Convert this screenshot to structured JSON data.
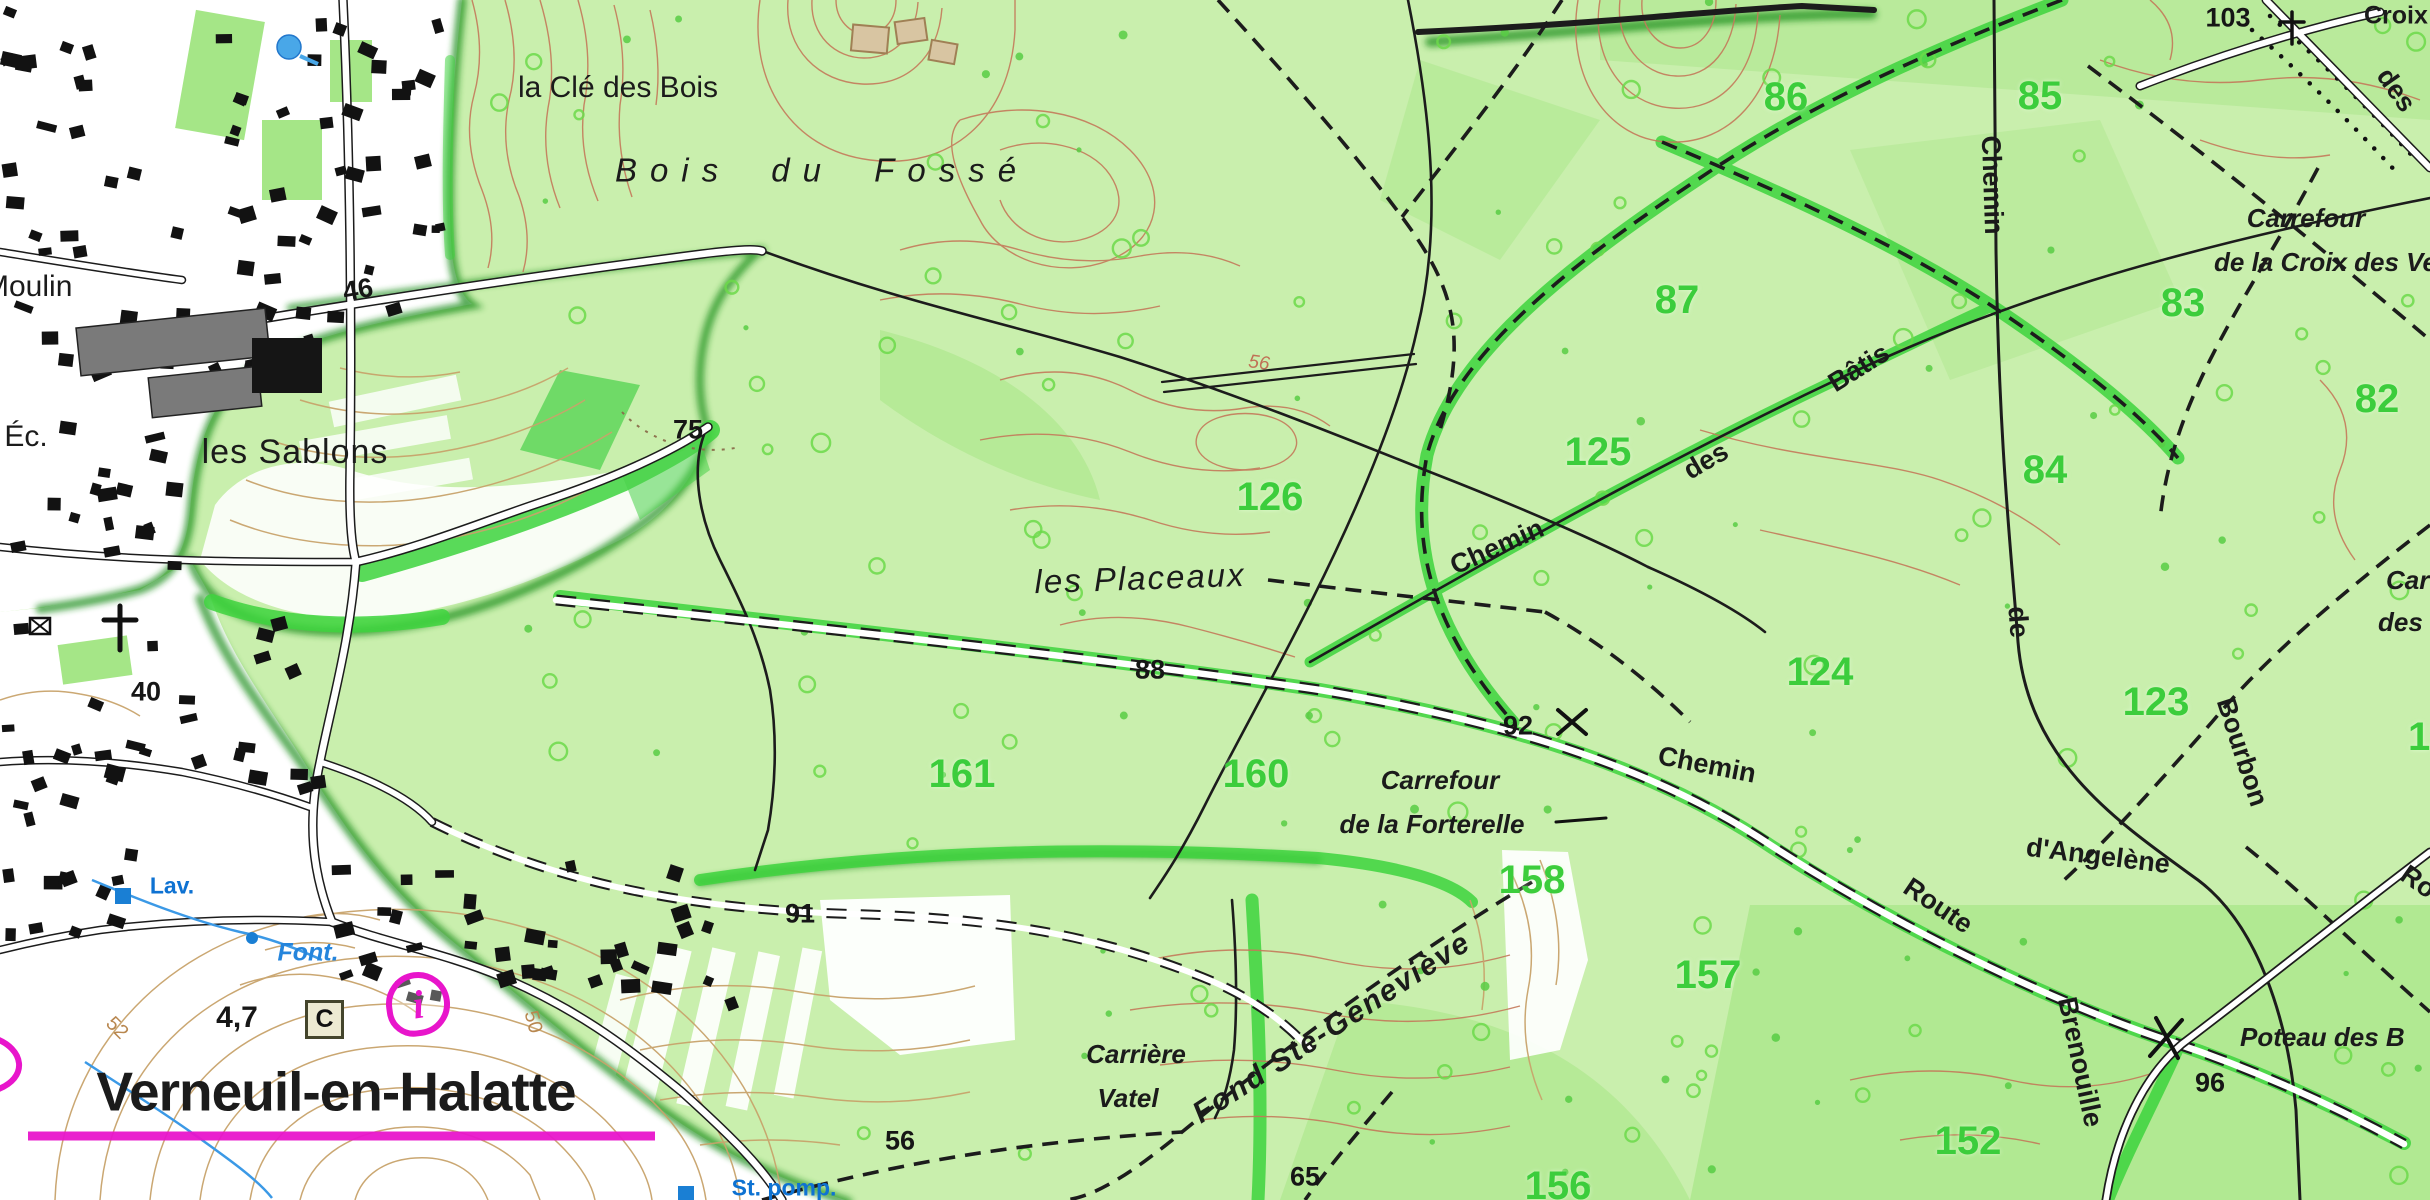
{
  "map_title": "Verneuil-en-Halatte forest topographic map extract",
  "colors": {
    "forest_base": "#c9efad",
    "forest_medium": "#8fe06a",
    "path_highlight": "#3ed43e",
    "forest_edge_dark": "#1f8f1f",
    "contour_open": "#c8a36b",
    "contour_forest": "#c4795a",
    "parcel_number_green": "#3ccd3c",
    "hydro_blue": "#1a7fd4",
    "tourism_magenta": "#e815cb",
    "road_black": "#1c1c1c",
    "urban_white": "#ffffff"
  },
  "symbols": {
    "info": "i",
    "cadastre_box": "C",
    "cross_103": "calvary-cross",
    "cross_verneuil": "calvary-cross",
    "crossing_92": "x-mark",
    "crossing_96": "x-mark"
  },
  "labels": [
    {
      "name": "place-la-cle-des-bois",
      "text": "la Clé des Bois",
      "x": 618,
      "y": 88,
      "rot": 0,
      "cls": "place"
    },
    {
      "name": "place-bois-du-fosse",
      "text": "Bois du Fossé",
      "x": 822,
      "y": 170,
      "rot": 0,
      "cls": "wood"
    },
    {
      "name": "place-les-sablons",
      "text": "les Sablons",
      "x": 295,
      "y": 452,
      "rot": 0,
      "cls": "place-lg"
    },
    {
      "name": "place-les-placeaux",
      "text": "les Placeaux",
      "x": 1140,
      "y": 578,
      "rot": -2,
      "cls": "lieu"
    },
    {
      "name": "place-moulin",
      "text": "Moulin",
      "x": -16,
      "y": 287,
      "rot": 0,
      "cls": "place anchor-l"
    },
    {
      "name": "place-ec",
      "text": "Éc.",
      "x": 26,
      "y": 437,
      "rot": 0,
      "cls": "place"
    },
    {
      "name": "town-verneuil-en-halatte",
      "text": "Verneuil-en-Halatte",
      "x": 336,
      "y": 1092,
      "rot": 0,
      "cls": "town"
    },
    {
      "name": "place-carriere",
      "text": "Carrière",
      "x": 1136,
      "y": 1054,
      "rot": 0,
      "cls": "carrefour"
    },
    {
      "name": "place-vatel",
      "text": "Vatel",
      "x": 1128,
      "y": 1098,
      "rot": 0,
      "cls": "carrefour"
    },
    {
      "name": "place-fond-ste-genevieve",
      "text": "Fond Ste-Geneviève",
      "x": 1332,
      "y": 1028,
      "rot": -33,
      "cls": "carrefour-lg"
    },
    {
      "name": "carrefour-forterelle-line1",
      "text": "Carrefour",
      "x": 1440,
      "y": 780,
      "rot": 0,
      "cls": "carrefour"
    },
    {
      "name": "carrefour-forterelle-line2",
      "text": "de la Forterelle",
      "x": 1432,
      "y": 824,
      "rot": 0,
      "cls": "carrefour"
    },
    {
      "name": "carrefour-croix-veneurs-line1",
      "text": "Carrefour",
      "x": 2306,
      "y": 218,
      "rot": 0,
      "cls": "carrefour"
    },
    {
      "name": "carrefour-croix-veneurs-line2",
      "text": "de la Croix des Veneu",
      "x": 2214,
      "y": 262,
      "rot": 0,
      "cls": "carrefour anchor-l"
    },
    {
      "name": "place-poteau-des-b",
      "text": "Poteau des B",
      "x": 2240,
      "y": 1037,
      "rot": 0,
      "cls": "carrefour anchor-l"
    },
    {
      "name": "place-car-cut",
      "text": "Car",
      "x": 2386,
      "y": 580,
      "rot": 0,
      "cls": "carrefour anchor-l"
    },
    {
      "name": "place-des-v-cut",
      "text": "des V",
      "x": 2378,
      "y": 622,
      "rot": 0,
      "cls": "carrefour anchor-l"
    },
    {
      "name": "place-croix",
      "text": "Croix",
      "x": 2364,
      "y": 16,
      "rot": 0,
      "cls": "croix anchor-l"
    },
    {
      "name": "parcel-86",
      "text": "86",
      "x": 1786,
      "y": 97,
      "rot": 0,
      "cls": "parcel"
    },
    {
      "name": "parcel-85",
      "text": "85",
      "x": 2040,
      "y": 96,
      "rot": 0,
      "cls": "parcel"
    },
    {
      "name": "parcel-87",
      "text": "87",
      "x": 1677,
      "y": 300,
      "rot": 0,
      "cls": "parcel"
    },
    {
      "name": "parcel-83",
      "text": "83",
      "x": 2183,
      "y": 303,
      "rot": 0,
      "cls": "parcel"
    },
    {
      "name": "parcel-82",
      "text": "82",
      "x": 2377,
      "y": 399,
      "rot": 0,
      "cls": "parcel"
    },
    {
      "name": "parcel-84",
      "text": "84",
      "x": 2045,
      "y": 470,
      "rot": 0,
      "cls": "parcel"
    },
    {
      "name": "parcel-125",
      "text": "125",
      "x": 1598,
      "y": 452,
      "rot": 0,
      "cls": "parcel"
    },
    {
      "name": "parcel-126",
      "text": "126",
      "x": 1270,
      "y": 497,
      "rot": 0,
      "cls": "parcel"
    },
    {
      "name": "parcel-124",
      "text": "124",
      "x": 1820,
      "y": 672,
      "rot": 0,
      "cls": "parcel"
    },
    {
      "name": "parcel-123",
      "text": "123",
      "x": 2156,
      "y": 702,
      "rot": 0,
      "cls": "parcel"
    },
    {
      "name": "parcel-12-cut",
      "text": "12",
      "x": 2408,
      "y": 737,
      "rot": 0,
      "cls": "parcel anchor-l"
    },
    {
      "name": "parcel-161",
      "text": "161",
      "x": 962,
      "y": 774,
      "rot": 0,
      "cls": "parcel"
    },
    {
      "name": "parcel-160",
      "text": "160",
      "x": 1256,
      "y": 774,
      "rot": 0,
      "cls": "parcel"
    },
    {
      "name": "parcel-158",
      "text": "158",
      "x": 1532,
      "y": 880,
      "rot": 0,
      "cls": "parcel"
    },
    {
      "name": "parcel-157",
      "text": "157",
      "x": 1708,
      "y": 975,
      "rot": 0,
      "cls": "parcel"
    },
    {
      "name": "parcel-156",
      "text": "156",
      "x": 1558,
      "y": 1186,
      "rot": 0,
      "cls": "parcel"
    },
    {
      "name": "parcel-152",
      "text": "152",
      "x": 1968,
      "y": 1141,
      "rot": 0,
      "cls": "parcel"
    },
    {
      "name": "spot-103",
      "text": "103",
      "x": 2228,
      "y": 18,
      "rot": 0,
      "cls": "spot"
    },
    {
      "name": "spot-75",
      "text": "75",
      "x": 688,
      "y": 430,
      "rot": 0,
      "cls": "spot"
    },
    {
      "name": "spot-88",
      "text": "88",
      "x": 1150,
      "y": 670,
      "rot": 0,
      "cls": "spot"
    },
    {
      "name": "spot-92",
      "text": "92",
      "x": 1518,
      "y": 726,
      "rot": 0,
      "cls": "spot"
    },
    {
      "name": "spot-91",
      "text": "91",
      "x": 800,
      "y": 914,
      "rot": 0,
      "cls": "spot"
    },
    {
      "name": "spot-56",
      "text": "56",
      "x": 900,
      "y": 1141,
      "rot": 0,
      "cls": "spot"
    },
    {
      "name": "spot-65",
      "text": "65",
      "x": 1305,
      "y": 1177,
      "rot": 0,
      "cls": "spot"
    },
    {
      "name": "spot-96",
      "text": "96",
      "x": 2210,
      "y": 1083,
      "rot": 0,
      "cls": "spot"
    },
    {
      "name": "spot-46",
      "text": "46",
      "x": 358,
      "y": 290,
      "rot": -10,
      "cls": "spot"
    },
    {
      "name": "spot-40",
      "text": "40",
      "x": 146,
      "y": 692,
      "rot": 0,
      "cls": "spot"
    },
    {
      "name": "spot-4-7",
      "text": "4,7",
      "x": 237,
      "y": 1018,
      "rot": 0,
      "cls": "spot-b"
    },
    {
      "name": "contour-50",
      "text": "50",
      "x": 533,
      "y": 1022,
      "rot": 75,
      "cls": "contour-lbl"
    },
    {
      "name": "contour-56",
      "text": "56",
      "x": 1259,
      "y": 363,
      "rot": 8,
      "cls": "contour-sal"
    },
    {
      "name": "contour-52",
      "text": "52",
      "x": 117,
      "y": 1028,
      "rot": 45,
      "cls": "contour-lbl"
    },
    {
      "name": "road-chemin-north",
      "text": "Chemin",
      "x": 1992,
      "y": 185,
      "rot": 88,
      "cls": "road"
    },
    {
      "name": "road-de-bourbon",
      "text": "de",
      "x": 2018,
      "y": 622,
      "rot": 86,
      "cls": "road"
    },
    {
      "name": "road-bourbon",
      "text": "Bourbon",
      "x": 2242,
      "y": 752,
      "rot": 72,
      "cls": "road"
    },
    {
      "name": "road-chemin-batis-1",
      "text": "Chemin",
      "x": 1497,
      "y": 547,
      "rot": -24,
      "cls": "road"
    },
    {
      "name": "road-chemin-batis-2",
      "text": "des",
      "x": 1706,
      "y": 461,
      "rot": -30,
      "cls": "road"
    },
    {
      "name": "road-chemin-batis-3",
      "text": "Bâtis",
      "x": 1859,
      "y": 368,
      "rot": -32,
      "cls": "road"
    },
    {
      "name": "road-chemin-angelene",
      "text": "Chemin",
      "x": 1707,
      "y": 765,
      "rot": 11,
      "cls": "road"
    },
    {
      "name": "road-dangelene",
      "text": "d'Angelène",
      "x": 2098,
      "y": 856,
      "rot": 7,
      "cls": "road"
    },
    {
      "name": "road-route",
      "text": "Route",
      "x": 1938,
      "y": 906,
      "rot": 34,
      "cls": "road"
    },
    {
      "name": "road-brenouille",
      "text": "Brenouille",
      "x": 2080,
      "y": 1062,
      "rot": 78,
      "cls": "road"
    },
    {
      "name": "road-ro-cut",
      "text": "Ro",
      "x": 2400,
      "y": 882,
      "rot": 35,
      "cls": "road anchor-l"
    },
    {
      "name": "road-des-ne",
      "text": "des",
      "x": 2396,
      "y": 90,
      "rot": 55,
      "cls": "road"
    },
    {
      "name": "hydro-lav",
      "text": "Lav.",
      "x": 172,
      "y": 886,
      "rot": 0,
      "cls": "blue"
    },
    {
      "name": "hydro-font",
      "text": "Font.",
      "x": 308,
      "y": 953,
      "rot": 0,
      "cls": "blue-i"
    },
    {
      "name": "hydro-st-pomp",
      "text": "St. pomp.",
      "x": 784,
      "y": 1188,
      "rot": 0,
      "cls": "blue"
    }
  ]
}
